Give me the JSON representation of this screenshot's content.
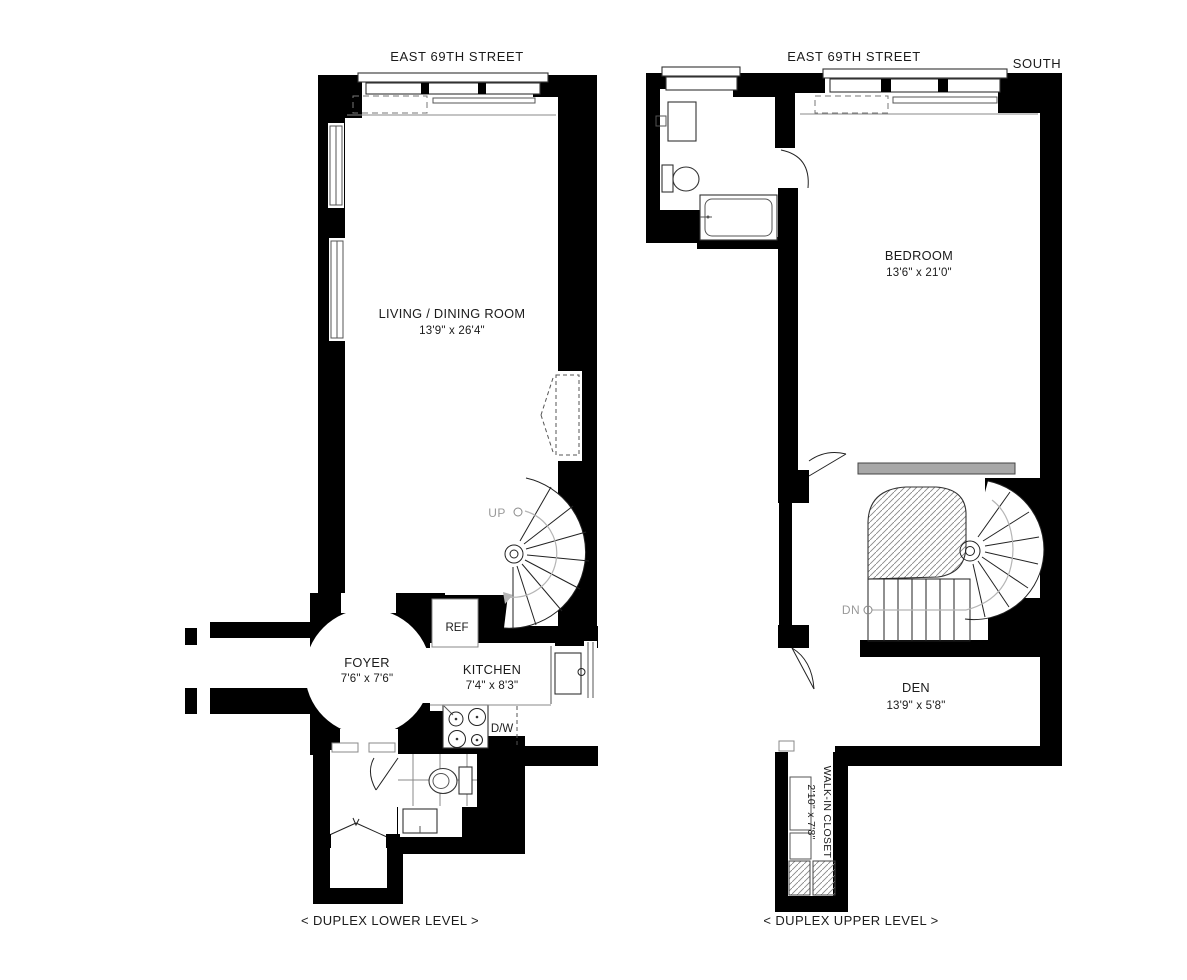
{
  "colors": {
    "wall": "#000000",
    "stair_label_gray": "#9a9a9a",
    "radiator_gray": "#a8a8a8"
  },
  "lower_level": {
    "street_label": "EAST 69TH STREET",
    "caption": "< DUPLEX LOWER LEVEL >",
    "living_room": {
      "name": "LIVING / DINING ROOM",
      "dims": "13'9\" x 26'4\""
    },
    "foyer": {
      "name": "FOYER",
      "dims": "7'6\" x 7'6\""
    },
    "kitchen": {
      "name": "KITCHEN",
      "dims": "7'4\" x 8'3\""
    },
    "refrigerator_label": "REF",
    "dishwasher_label": "D/W",
    "stairs_up_label": "UP"
  },
  "upper_level": {
    "street_label": "EAST 69TH STREET",
    "compass_label": "SOUTH",
    "caption": "< DUPLEX UPPER LEVEL >",
    "bedroom": {
      "name": "BEDROOM",
      "dims": "13'6\" x 21'0\""
    },
    "den": {
      "name": "DEN",
      "dims": "13'9\" x 5'8\""
    },
    "walk_in_closet": {
      "name": "WALK-IN CLOSET",
      "dims": "2'10\" x 7'8\""
    },
    "stairs_down_label": "DN"
  }
}
